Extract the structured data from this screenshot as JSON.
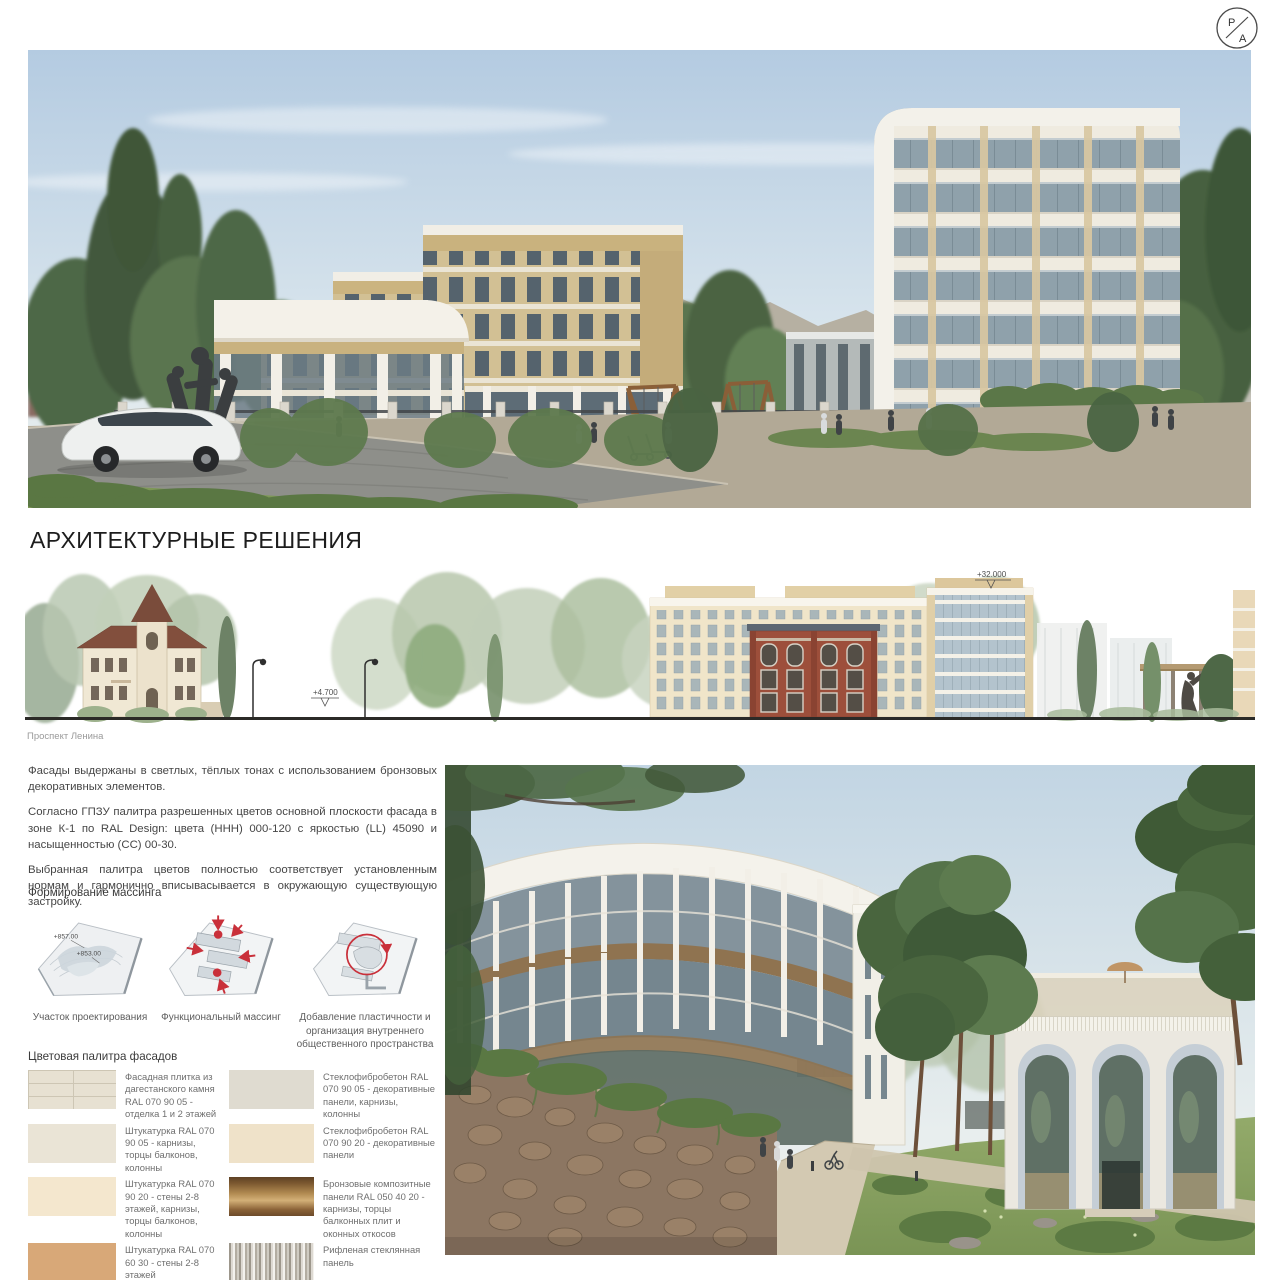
{
  "logo": {
    "letter_top": "Р",
    "letter_bottom": "А"
  },
  "title": "АРХИТЕКТУРНЫЕ РЕШЕНИЯ",
  "intro_paragraphs": [
    "Фасады выдержаны в светлых, тёплых тонах с использованием бронзовых декоративных элементов.",
    "Согласно ГПЗУ палитра разрешенных цветов основной плоскости фасада в зоне К-1 по RAL Design: цвета (ННН) 000-120 с яркостью (LL) 45090 и насыщенностью (СС) 00-30.",
    "Выбранная палитра цветов полностью соответствует установленным нормам и  гармонично вписывасывается в окружающую существующую застройку."
  ],
  "elevation": {
    "caption": "Проспект Ленина",
    "level_top": "+32.000",
    "level_street": "+4.700"
  },
  "massing": {
    "heading": "Формирование массинга",
    "site_levels": [
      "+857.00",
      "+853.00"
    ],
    "captions": [
      "Участок проектирования",
      "Функциональный массинг",
      "Добавление пластичности и организация внутреннего общественного пространства"
    ]
  },
  "palette": {
    "heading": "Цветовая палитра фасадов",
    "items_left": [
      {
        "label": "Фасадная плитка из дагестанского камня RAL 070 90 05 - отделка 1 и 2 этажей",
        "color": "#e7e1d2",
        "texture": "tile"
      },
      {
        "label": "Штукатурка RAL 070 90 05 - карнизы, торцы балконов, колонны",
        "color": "#eae4d6",
        "texture": "plain"
      },
      {
        "label": "Штукатурка RAL 070 90 20 - стены 2-8 этажей, карнизы, торцы балконов, колонны",
        "color": "#f4e7ce",
        "texture": "plain"
      },
      {
        "label": "Штукатурка RAL 070 60 30 - стены 2-8 этажей",
        "color": "#d8a878",
        "texture": "plain"
      }
    ],
    "items_right": [
      {
        "label": "Стеклофибробетон RAL 070 90 05 - декоративные панели, карнизы, колонны",
        "color": "#dfdbd0",
        "texture": "plain"
      },
      {
        "label": "Стеклофибробетон RAL 070 90 20 - декоративные панели",
        "color": "#efe2c9",
        "texture": "plain"
      },
      {
        "label": "Бронзовые композитные панели RAL 050 40 20 - карнизы, торцы балконных плит и оконных откосов",
        "color": "#9c7342",
        "texture": "bronze"
      },
      {
        "label": "Рифленая стеклянная панель",
        "color": "#d9d6cf",
        "texture": "ribbed-glass"
      }
    ]
  }
}
